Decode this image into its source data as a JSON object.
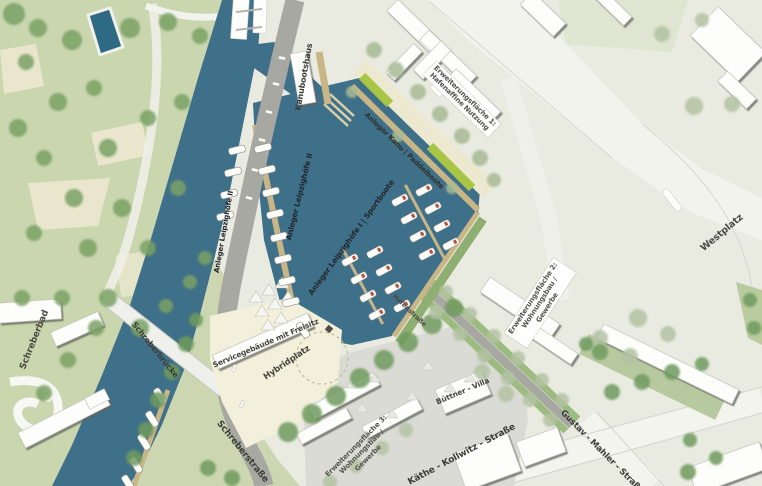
{
  "map": {
    "labels": {
      "schreberbad": "Schreberbad",
      "schreberbruecke": "Schreberbrücke",
      "schreberstrasse": "Schreberstraße",
      "kanubootshaus": "Kanubootshaus",
      "anleger_leipzighoefe_2": "Anleger Leipzighöfe II",
      "anleger_leipzighoefe_1": "Anleger Leipzighöfe I | Sportboote",
      "anleger_kanu": "Anleger Kanu | Paddelboote",
      "erweiterungsflaeche_1": "Erweiterungsfläche 1:\nHafenaffine Nutzung",
      "erweiterungsflaeche_2": "Erweiterungsfläche 2:\nWohnungsbau /\nGewerbe",
      "erweiterungsflaeche_3": "Erweiterungsfläche 3:\nWohnungsbau /\nGewerbe",
      "westplatz": "Westplatz",
      "servicegebaeude": "Servicegebäude mit Freisitz",
      "hybridplatz": "Hybridplatz",
      "buettner_villa": "Büttner - Villa",
      "kaethe_kollwitz_strasse": "Käthe - Kollwitz - Straße",
      "gustav_mahler_strasse": "Gustav - Mahler - Straße",
      "hafenstrasse": "Hafenstraße"
    },
    "colors": {
      "water": "#3f7089",
      "park_green": "#c9d6ae",
      "tree_green": "#79a164",
      "dock_tan": "#c9b687",
      "lime_green": "#a9c545",
      "street_light": "#f2f3ed",
      "road_gray": "#a8a8a3",
      "block_gray": "#dadbd4",
      "plaza_cream": "#f2efdb",
      "label_dark": "#3c3c36"
    }
  }
}
